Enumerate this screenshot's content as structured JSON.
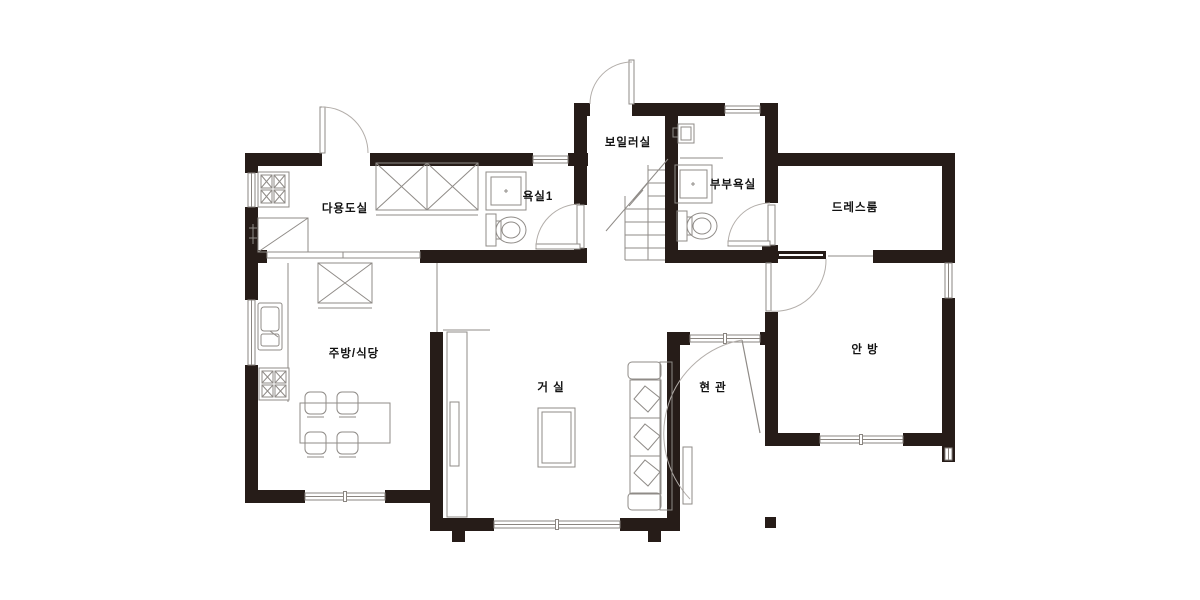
{
  "title": "주택 평면도 (house floor plan)",
  "colors": {
    "wall": "#261c18",
    "thin_line": "#8f8b87",
    "door_arc": "#b3aeaa",
    "label": "#121212",
    "background": "#ffffff"
  },
  "rooms": {
    "utility": {
      "label": "다용도실"
    },
    "bath1": {
      "label": "욕실1"
    },
    "boiler": {
      "label": "보일러실"
    },
    "master_bath": {
      "label": "부부욕실"
    },
    "dressroom": {
      "label": "드레스룸"
    },
    "kitchen_dining": {
      "label": "주방/식당"
    },
    "living": {
      "label": "거 실"
    },
    "entrance": {
      "label": "현 관"
    },
    "master_bedroom": {
      "label": "안 방"
    }
  },
  "fixtures": [
    "gas-stove-utility",
    "laundry-cabinet-x2",
    "corner-cabinet",
    "shower-booth-bath1",
    "toilet-bath1",
    "boiler-stairs",
    "wash-basin",
    "shower-booth-master",
    "toilet-master",
    "kitchen-sink",
    "gas-stove-kitchen",
    "pantry-cabinet",
    "dining-table-4-chairs",
    "tv-console",
    "coffee-table",
    "sofa",
    "shoe-cabinet"
  ],
  "door_count": 6,
  "window_count": 10
}
